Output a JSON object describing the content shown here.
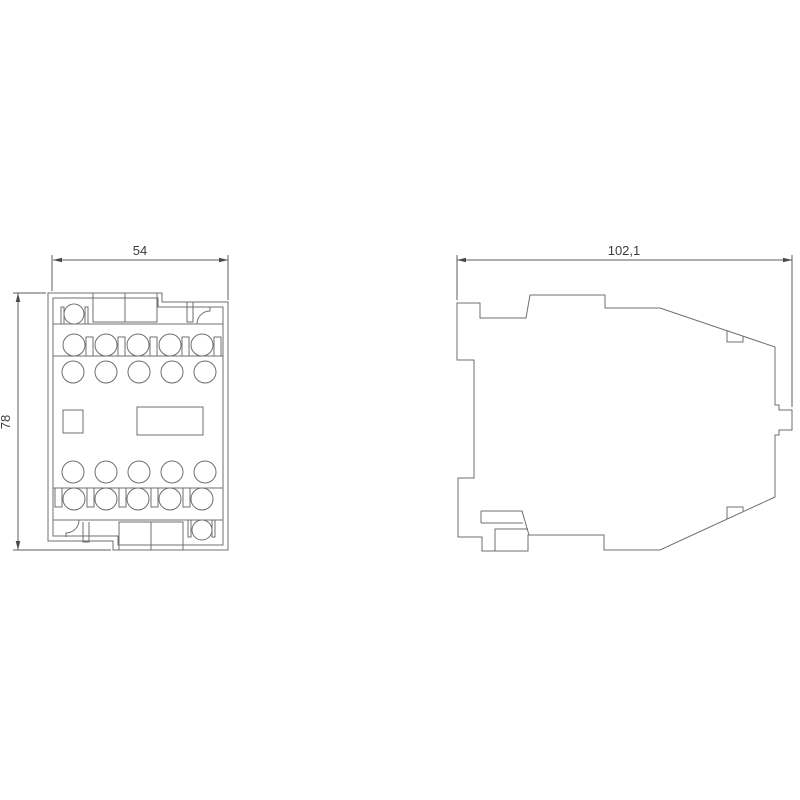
{
  "drawing": {
    "background": "#ffffff",
    "line_color": "#6f6f6f",
    "dim_color": "#5e5e5e",
    "arrow_color": "#4a4a4a",
    "text_color": "#3c3c3c",
    "views": {
      "front": {
        "width_label": "54",
        "height_label": "78"
      },
      "side": {
        "depth_label": "102,1"
      }
    }
  }
}
